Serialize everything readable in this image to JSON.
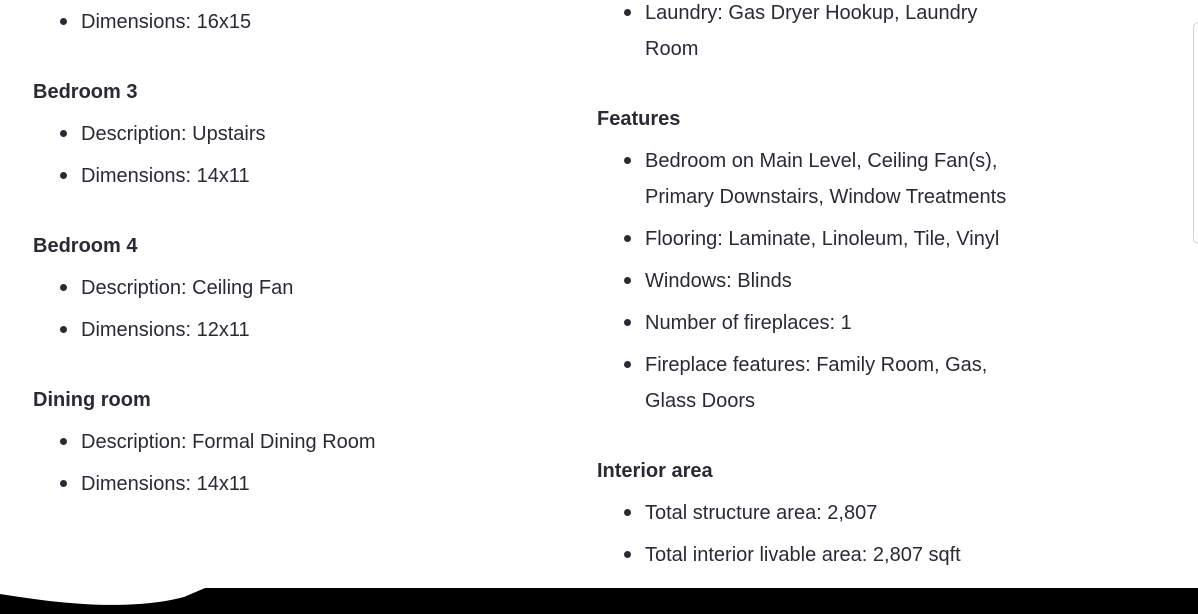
{
  "theme": {
    "background": "#ffffff",
    "text_color": "#2a2a33",
    "bottom_bar_color": "#000000",
    "edge_line_color": "#d6d6d6"
  },
  "left_column": {
    "leading_items": [
      "Dimensions: 16x15"
    ],
    "sections": [
      {
        "heading": "Bedroom 3",
        "items": [
          "Description: Upstairs",
          "Dimensions: 14x11"
        ]
      },
      {
        "heading": "Bedroom 4",
        "items": [
          "Description: Ceiling Fan",
          "Dimensions: 12x11"
        ]
      },
      {
        "heading": "Dining room",
        "items": [
          "Description: Formal Dining Room",
          "Dimensions: 14x11"
        ]
      }
    ]
  },
  "right_column": {
    "leading_items": [
      "Laundry: Gas Dryer Hookup, Laundry Room"
    ],
    "sections": [
      {
        "heading": "Features",
        "items": [
          "Bedroom on Main Level, Ceiling Fan(s), Primary Downstairs, Window Treatments",
          "Flooring: Laminate, Linoleum, Tile, Vinyl",
          "Windows: Blinds",
          "Number of fireplaces: 1",
          "Fireplace features: Family Room, Gas, Glass Doors"
        ]
      },
      {
        "heading": "Interior area",
        "items": [
          "Total structure area: 2,807",
          "Total interior livable area: 2,807 sqft"
        ]
      }
    ]
  }
}
